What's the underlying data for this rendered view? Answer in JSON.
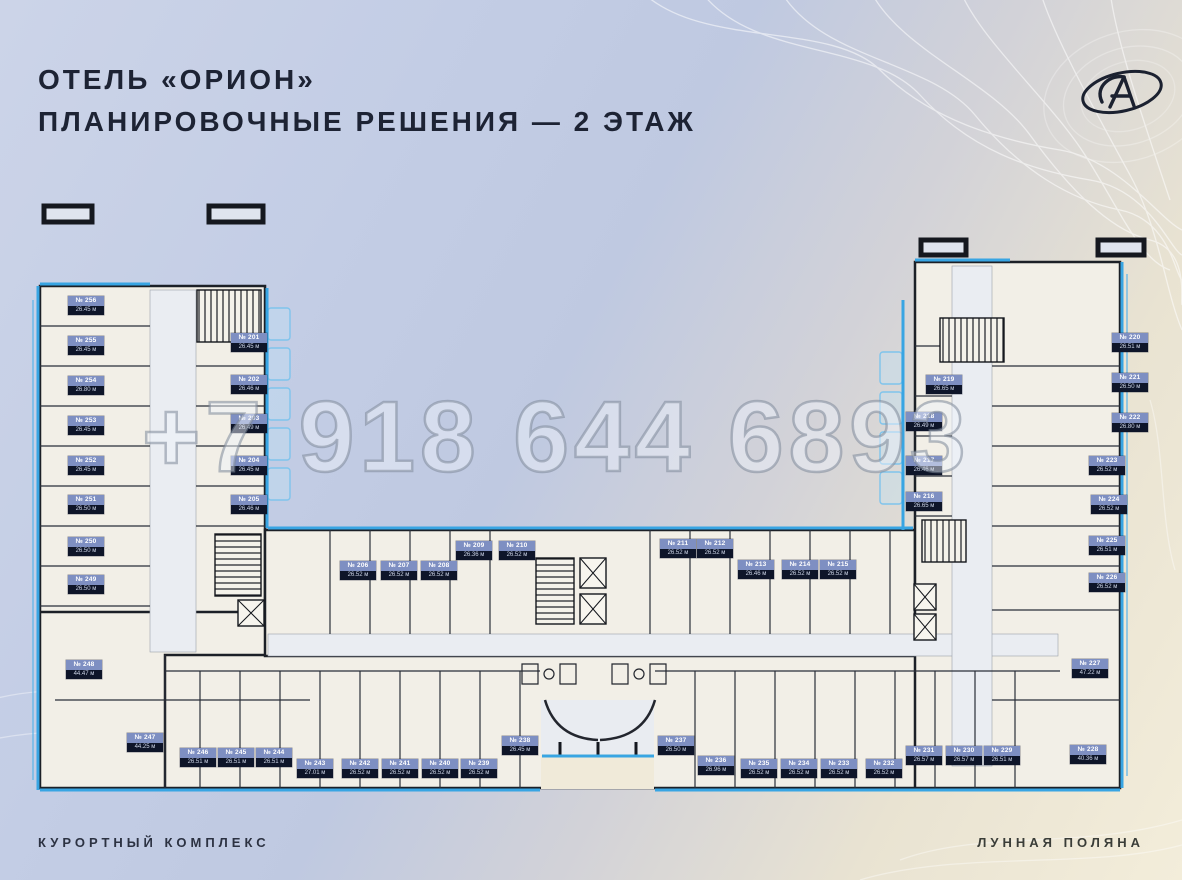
{
  "header": {
    "title_line1": "ОТЕЛЬ «ОРИОН»",
    "title_line2": "ПЛАНИРОВОЧНЫЕ РЕШЕНИЯ — 2 ЭТАЖ"
  },
  "footer": {
    "left": "КУРОРТНЫЙ КОМПЛЕКС",
    "right": "ЛУННАЯ ПОЛЯНА"
  },
  "watermark": "+7 918 644 6893",
  "logo": "orion-ellipse-monogram",
  "colors": {
    "title": "#1d2334",
    "glazing_blue": "#38a5e3",
    "chip_number_bg": "#7e8fc2",
    "chip_area_bg": "#0e1529",
    "room_fill": "#f2efe7",
    "background_top": "#ccd4e8",
    "background_bottom": "#f3edda"
  },
  "plan": {
    "floor": "2 этаж",
    "rooms": [
      {
        "number": "№ 201",
        "area": "26.45 м",
        "x": 231,
        "y": 333
      },
      {
        "number": "№ 202",
        "area": "26.46 м",
        "x": 231,
        "y": 375
      },
      {
        "number": "№ 203",
        "area": "26.49 м",
        "x": 231,
        "y": 414
      },
      {
        "number": "№ 204",
        "area": "26.45 м",
        "x": 231,
        "y": 456
      },
      {
        "number": "№ 205",
        "area": "26.46 м",
        "x": 231,
        "y": 495
      },
      {
        "number": "№ 206",
        "area": "26.52 м",
        "x": 340,
        "y": 561
      },
      {
        "number": "№ 207",
        "area": "26.52 м",
        "x": 381,
        "y": 561
      },
      {
        "number": "№ 208",
        "area": "26.52 м",
        "x": 421,
        "y": 561
      },
      {
        "number": "№ 209",
        "area": "26.36 м",
        "x": 456,
        "y": 541
      },
      {
        "number": "№ 210",
        "area": "26.52 м",
        "x": 499,
        "y": 541
      },
      {
        "number": "№ 211",
        "area": "26.52 м",
        "x": 660,
        "y": 539
      },
      {
        "number": "№ 212",
        "area": "26.52 м",
        "x": 697,
        "y": 539
      },
      {
        "number": "№ 213",
        "area": "26.46 м",
        "x": 738,
        "y": 560
      },
      {
        "number": "№ 214",
        "area": "26.52 м",
        "x": 782,
        "y": 560
      },
      {
        "number": "№ 215",
        "area": "26.52 м",
        "x": 820,
        "y": 560
      },
      {
        "number": "№ 216",
        "area": "26.65 м",
        "x": 906,
        "y": 492
      },
      {
        "number": "№ 217",
        "area": "26.46 м",
        "x": 906,
        "y": 456
      },
      {
        "number": "№ 218",
        "area": "26.49 м",
        "x": 906,
        "y": 412
      },
      {
        "number": "№ 219",
        "area": "26.65 м",
        "x": 926,
        "y": 375
      },
      {
        "number": "№ 220",
        "area": "26.51 м",
        "x": 1112,
        "y": 333
      },
      {
        "number": "№ 221",
        "area": "26.50 м",
        "x": 1112,
        "y": 373
      },
      {
        "number": "№ 222",
        "area": "26.80 м",
        "x": 1112,
        "y": 413
      },
      {
        "number": "№ 223",
        "area": "26.52 м",
        "x": 1089,
        "y": 456
      },
      {
        "number": "№ 224",
        "area": "26.52 м",
        "x": 1091,
        "y": 495
      },
      {
        "number": "№ 225",
        "area": "26.51 м",
        "x": 1089,
        "y": 536
      },
      {
        "number": "№ 226",
        "area": "26.52 м",
        "x": 1089,
        "y": 573
      },
      {
        "number": "№ 227",
        "area": "47.22 м",
        "x": 1072,
        "y": 659
      },
      {
        "number": "№ 228",
        "area": "40.36 м",
        "x": 1070,
        "y": 745
      },
      {
        "number": "№ 229",
        "area": "26.51 м",
        "x": 984,
        "y": 746
      },
      {
        "number": "№ 230",
        "area": "26.57 м",
        "x": 946,
        "y": 746
      },
      {
        "number": "№ 231",
        "area": "26.57 м",
        "x": 906,
        "y": 746
      },
      {
        "number": "№ 232",
        "area": "26.52 м",
        "x": 866,
        "y": 759
      },
      {
        "number": "№ 233",
        "area": "26.52 м",
        "x": 821,
        "y": 759
      },
      {
        "number": "№ 234",
        "area": "26.52 м",
        "x": 781,
        "y": 759
      },
      {
        "number": "№ 235",
        "area": "26.52 м",
        "x": 741,
        "y": 759
      },
      {
        "number": "№ 236",
        "area": "26.96 м",
        "x": 698,
        "y": 756
      },
      {
        "number": "№ 237",
        "area": "26.50 м",
        "x": 658,
        "y": 736
      },
      {
        "number": "№ 238",
        "area": "26.45 м",
        "x": 502,
        "y": 736
      },
      {
        "number": "№ 239",
        "area": "26.52 м",
        "x": 461,
        "y": 759
      },
      {
        "number": "№ 240",
        "area": "26.52 м",
        "x": 422,
        "y": 759
      },
      {
        "number": "№ 241",
        "area": "26.52 м",
        "x": 382,
        "y": 759
      },
      {
        "number": "№ 242",
        "area": "26.52 м",
        "x": 342,
        "y": 759
      },
      {
        "number": "№ 243",
        "area": "27.01 м",
        "x": 297,
        "y": 759
      },
      {
        "number": "№ 244",
        "area": "26.51 м",
        "x": 256,
        "y": 748
      },
      {
        "number": "№ 245",
        "area": "26.51 м",
        "x": 218,
        "y": 748
      },
      {
        "number": "№ 246",
        "area": "26.51 м",
        "x": 180,
        "y": 748
      },
      {
        "number": "№ 247",
        "area": "44.25 м",
        "x": 127,
        "y": 733
      },
      {
        "number": "№ 248",
        "area": "44.47 м",
        "x": 66,
        "y": 660
      },
      {
        "number": "№ 249",
        "area": "26.50 м",
        "x": 68,
        "y": 575
      },
      {
        "number": "№ 250",
        "area": "26.50 м",
        "x": 68,
        "y": 537
      },
      {
        "number": "№ 251",
        "area": "26.50 м",
        "x": 68,
        "y": 495
      },
      {
        "number": "№ 252",
        "area": "26.45 м",
        "x": 68,
        "y": 456
      },
      {
        "number": "№ 253",
        "area": "26.45 м",
        "x": 68,
        "y": 416
      },
      {
        "number": "№ 254",
        "area": "26.80 м",
        "x": 68,
        "y": 376
      },
      {
        "number": "№ 255",
        "area": "26.45 м",
        "x": 68,
        "y": 336
      },
      {
        "number": "№ 256",
        "area": "26.45 м",
        "x": 68,
        "y": 296
      }
    ]
  }
}
